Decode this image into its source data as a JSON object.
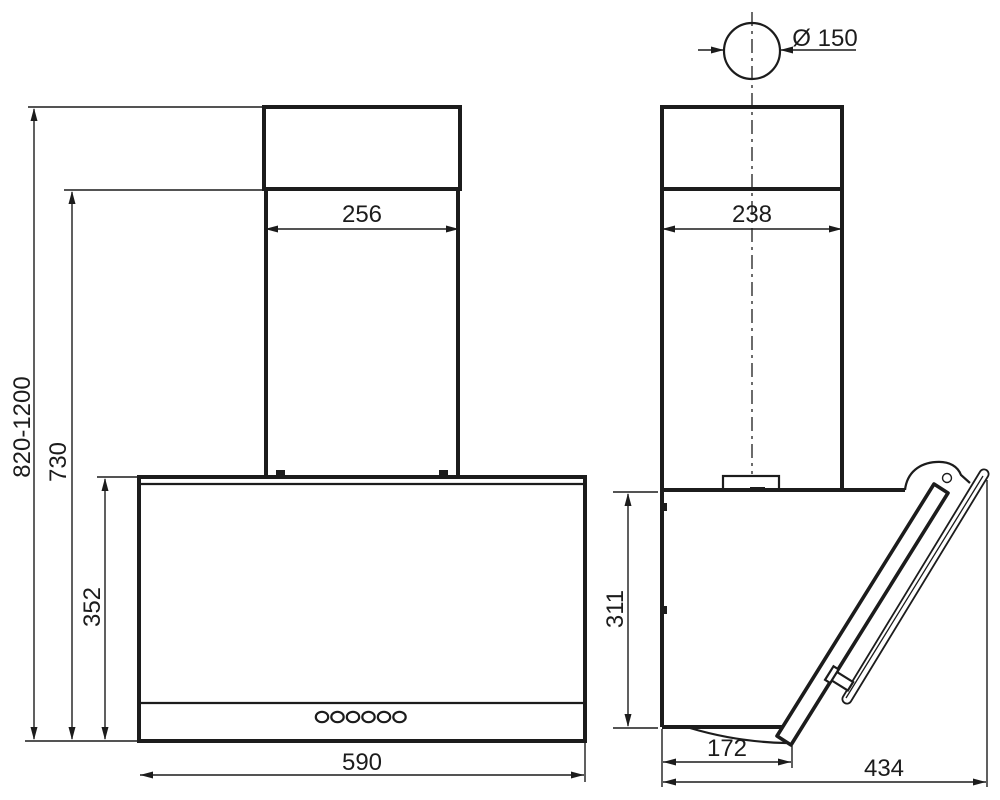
{
  "diagram": {
    "front_view": {
      "chimney_width": "256",
      "total_height_range": "820-1200",
      "height_to_chimney_joint": "730",
      "body_height": "352",
      "body_width": "590"
    },
    "side_view": {
      "duct_diameter": "Ø 150",
      "chimney_depth": "238",
      "body_height": "311",
      "body_bottom_depth": "172",
      "total_depth": "434"
    }
  }
}
